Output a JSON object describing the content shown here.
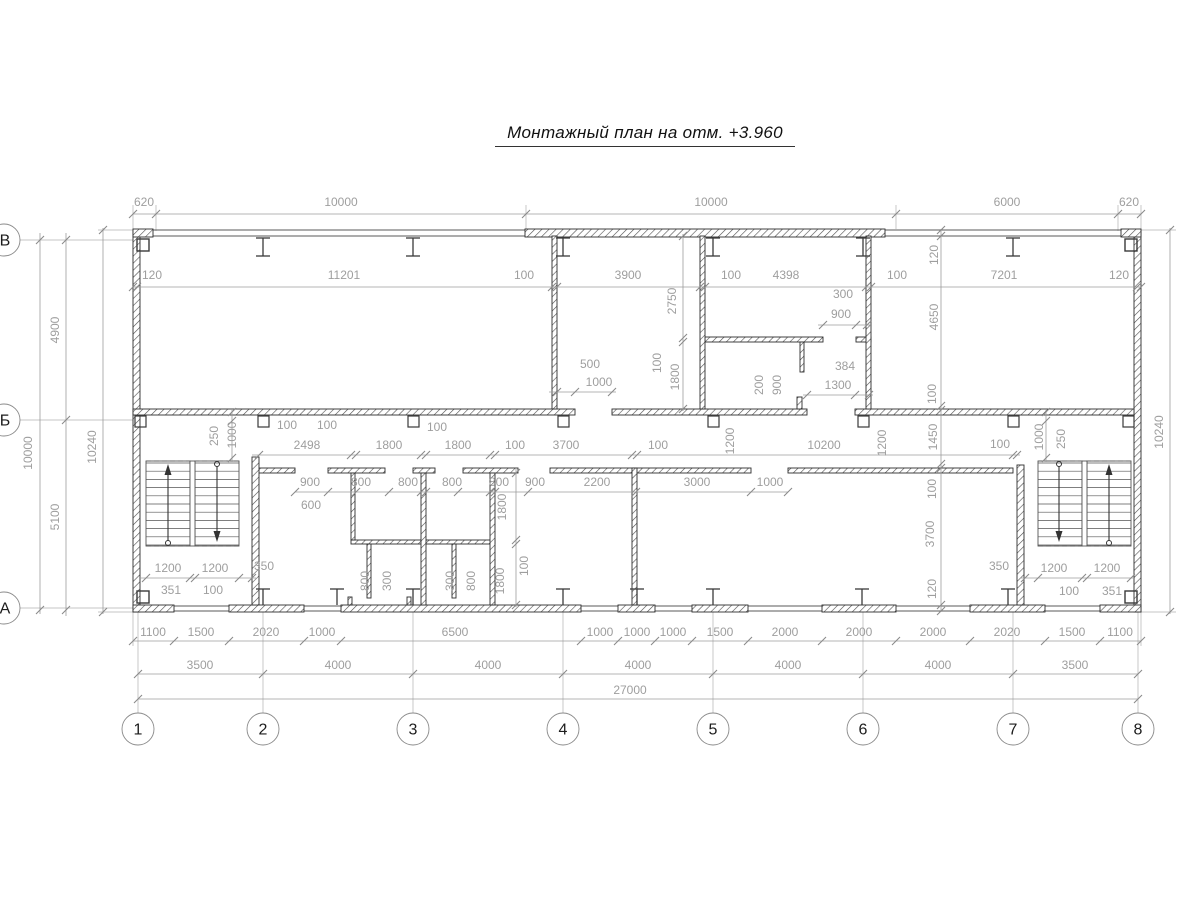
{
  "plan": {
    "title": "Монтажный план на отм. +3.960",
    "colors": {
      "wall_stroke": "#2d2d2d",
      "hatch": "#4f4f4f",
      "dim_line": "#9c9c9c",
      "dim_text": "#9e9e9e",
      "axis_text": "#1c1c1c",
      "thin_wall": "#5a5a5a",
      "ext_line": "#b0b0b0",
      "symbol": "#3a3a3a",
      "stair": "#555555"
    },
    "axes_bottom": [
      {
        "label": "1",
        "x": 138
      },
      {
        "label": "2",
        "x": 263
      },
      {
        "label": "3",
        "x": 413
      },
      {
        "label": "4",
        "x": 563
      },
      {
        "label": "5",
        "x": 713
      },
      {
        "label": "6",
        "x": 863
      },
      {
        "label": "7",
        "x": 1013
      },
      {
        "label": "8",
        "x": 1138
      }
    ],
    "axes_bottom_y": 729,
    "axes_r": 16,
    "axes_left": [
      {
        "label": "В",
        "y": 240
      },
      {
        "label": "Б",
        "y": 420
      },
      {
        "label": "А",
        "y": 608
      }
    ],
    "window_lines": [
      [
        133,
        230,
        1141,
        230
      ],
      [
        133,
        236,
        1141,
        236
      ],
      [
        133,
        606,
        1141,
        606
      ],
      [
        133,
        611,
        1141,
        611
      ]
    ],
    "walls": [
      [
        133,
        230,
        7,
        382
      ],
      [
        1134,
        230,
        7,
        382
      ],
      [
        133,
        229,
        20,
        8
      ],
      [
        1121,
        229,
        20,
        8
      ],
      [
        525,
        229,
        360,
        8
      ],
      [
        133,
        605,
        41,
        7
      ],
      [
        229,
        605,
        75,
        7
      ],
      [
        341,
        605,
        240,
        7
      ],
      [
        618,
        605,
        37,
        7
      ],
      [
        692,
        605,
        56,
        7
      ],
      [
        822,
        605,
        74,
        7
      ],
      [
        970,
        605,
        75,
        7
      ],
      [
        1100,
        605,
        41,
        7
      ],
      [
        133,
        409,
        442,
        6
      ],
      [
        612,
        409,
        195,
        6
      ],
      [
        855,
        409,
        279,
        6
      ],
      [
        258,
        468,
        37,
        5
      ],
      [
        328,
        468,
        57,
        5
      ],
      [
        413,
        468,
        22,
        5
      ],
      [
        463,
        468,
        55,
        5
      ],
      [
        550,
        468,
        201,
        5
      ],
      [
        788,
        468,
        225,
        5
      ],
      [
        705,
        337,
        118,
        5
      ],
      [
        856,
        337,
        15,
        5
      ],
      [
        351,
        540,
        144,
        4
      ],
      [
        552,
        236,
        5,
        173
      ],
      [
        700,
        236,
        5,
        173
      ],
      [
        866,
        236,
        5,
        173
      ],
      [
        252,
        457,
        7,
        148
      ],
      [
        1017,
        465,
        7,
        140
      ],
      [
        632,
        468,
        5,
        137
      ],
      [
        421,
        473,
        5,
        132
      ],
      [
        490,
        473,
        5,
        132
      ],
      [
        351,
        473,
        4,
        67
      ],
      [
        367,
        544,
        4,
        54
      ],
      [
        452,
        544,
        4,
        54
      ],
      [
        348,
        597,
        4,
        8
      ],
      [
        407,
        597,
        4,
        8
      ],
      [
        800,
        342,
        4,
        30
      ],
      [
        797,
        397,
        5,
        12
      ]
    ],
    "columns_top": [
      263,
      413,
      563,
      713,
      863,
      1013
    ],
    "columns_bottom": [
      263,
      337,
      413,
      563,
      637,
      713,
      862,
      1008
    ],
    "wall_stubs": [
      140,
      263,
      413,
      563,
      713,
      863,
      1013,
      1128
    ],
    "corner_squares": [
      [
        137,
        239
      ],
      [
        1125,
        239
      ],
      [
        137,
        591
      ],
      [
        1125,
        591
      ]
    ],
    "stairs": [
      {
        "flights": [
          [
            146,
            44
          ],
          [
            195,
            44
          ]
        ],
        "divider": [
          190,
          461,
          5,
          85
        ],
        "span": [
          146,
          239
        ],
        "dashed": [
          461,
          546
        ],
        "arrows": [
          {
            "x": 168,
            "dir": "up"
          },
          {
            "x": 217,
            "dir": "down"
          }
        ]
      },
      {
        "flights": [
          [
            1038,
            44
          ],
          [
            1087,
            44
          ]
        ],
        "divider": [
          1082,
          461,
          5,
          85
        ],
        "span": [
          1038,
          1131
        ],
        "dashed": [
          461,
          546
        ],
        "arrows": [
          {
            "x": 1059,
            "dir": "down"
          },
          {
            "x": 1109,
            "dir": "up"
          }
        ]
      }
    ],
    "stair_tread_top": 463,
    "stair_tread_bot": 545,
    "stair_treads": 10,
    "dim_lines": [
      {
        "o": "h",
        "c": 214,
        "a": 133,
        "b": 1141,
        "ticks": [
          133,
          156,
          526,
          896,
          1118,
          1141
        ]
      },
      {
        "o": "h",
        "c": 287,
        "a": 133,
        "b": 1141,
        "ticks": [
          133,
          137,
          552,
          557,
          700,
          705,
          866,
          871,
          1137,
          1141
        ]
      },
      {
        "o": "h",
        "c": 641,
        "a": 133,
        "b": 1141,
        "ticks": [
          133,
          174,
          229,
          304,
          341,
          581,
          618,
          655,
          692,
          748,
          822,
          896,
          970,
          1045,
          1100,
          1141
        ]
      },
      {
        "o": "h",
        "c": 674,
        "a": 138,
        "b": 1138,
        "ticks": [
          138,
          263,
          413,
          563,
          713,
          863,
          1013,
          1138
        ]
      },
      {
        "o": "h",
        "c": 699,
        "a": 138,
        "b": 1138,
        "ticks": [
          138,
          1138
        ]
      },
      {
        "o": "h",
        "c": 455,
        "a": 252,
        "b": 1020,
        "ticks": [
          259,
          351,
          356,
          421,
          426,
          490,
          495,
          632,
          637,
          1013,
          1017
        ]
      },
      {
        "o": "h",
        "c": 492,
        "a": 295,
        "b": 788,
        "ticks": [
          295,
          328,
          356,
          389,
          421,
          426,
          458,
          490,
          495,
          528,
          636,
          751,
          788
        ]
      },
      {
        "o": "h",
        "c": 392,
        "a": 549,
        "b": 616,
        "ticks": [
          557,
          575,
          612
        ]
      },
      {
        "o": "h",
        "c": 395,
        "a": 803,
        "b": 873,
        "ticks": [
          807,
          855,
          869
        ]
      },
      {
        "o": "h",
        "c": 325,
        "a": 818,
        "b": 871,
        "ticks": [
          823,
          856,
          867
        ]
      },
      {
        "o": "h",
        "c": 578,
        "a": 140,
        "b": 256,
        "ticks": [
          146,
          190,
          195,
          239,
          252
        ]
      },
      {
        "o": "h",
        "c": 578,
        "a": 1020,
        "b": 1134,
        "ticks": [
          1025,
          1038,
          1082,
          1087,
          1131
        ]
      },
      {
        "o": "v",
        "c": 40,
        "a": 233,
        "b": 614,
        "ticks": [
          240,
          610
        ]
      },
      {
        "o": "v",
        "c": 66,
        "a": 233,
        "b": 616,
        "ticks": [
          240,
          420,
          610
        ]
      },
      {
        "o": "v",
        "c": 103,
        "a": 228,
        "b": 614,
        "ticks": [
          230,
          612
        ]
      },
      {
        "o": "v",
        "c": 1170,
        "a": 228,
        "b": 614,
        "ticks": [
          230,
          612
        ]
      },
      {
        "o": "v",
        "c": 941,
        "a": 229,
        "b": 612,
        "ticks": [
          230,
          236,
          406,
          410,
          464,
          468,
          605,
          611
        ]
      },
      {
        "o": "v",
        "c": 683,
        "a": 234,
        "b": 411,
        "ticks": [
          236,
          338,
          342,
          409
        ]
      },
      {
        "o": "v",
        "c": 232,
        "a": 409,
        "b": 462,
        "ticks": [
          412,
          421,
          458
        ]
      },
      {
        "o": "v",
        "c": 1046,
        "a": 409,
        "b": 462,
        "ticks": [
          412,
          421,
          458
        ]
      },
      {
        "o": "v",
        "c": 516,
        "a": 468,
        "b": 607,
        "ticks": [
          473,
          540,
          544,
          605
        ]
      }
    ],
    "ext_lines": [
      [
        156,
        205,
        156,
        231
      ],
      [
        526,
        205,
        526,
        229
      ],
      [
        896,
        205,
        896,
        229
      ],
      [
        1118,
        205,
        1118,
        231
      ],
      [
        133,
        205,
        133,
        229
      ],
      [
        1141,
        205,
        1141,
        229
      ],
      [
        552,
        240,
        552,
        292
      ],
      [
        557,
        240,
        557,
        292
      ],
      [
        700,
        240,
        700,
        292
      ],
      [
        705,
        240,
        705,
        292
      ],
      [
        866,
        240,
        866,
        292
      ],
      [
        871,
        240,
        871,
        292
      ],
      [
        133,
        240,
        133,
        292
      ],
      [
        137,
        240,
        137,
        292
      ],
      [
        1137,
        240,
        1137,
        292
      ],
      [
        1141,
        240,
        1141,
        292
      ],
      [
        138,
        612,
        138,
        713
      ],
      [
        263,
        612,
        263,
        713
      ],
      [
        413,
        612,
        413,
        713
      ],
      [
        563,
        612,
        563,
        713
      ],
      [
        713,
        612,
        713,
        713
      ],
      [
        863,
        612,
        863,
        713
      ],
      [
        1013,
        612,
        1013,
        713
      ],
      [
        1138,
        612,
        1138,
        713
      ],
      [
        133,
        612,
        133,
        646
      ],
      [
        1141,
        612,
        1141,
        646
      ],
      [
        20,
        240,
        133,
        240
      ],
      [
        20,
        420,
        133,
        420
      ],
      [
        20,
        608,
        133,
        608
      ],
      [
        98,
        230,
        133,
        230
      ],
      [
        98,
        612,
        133,
        612
      ],
      [
        1141,
        230,
        1176,
        230
      ],
      [
        1141,
        612,
        1176,
        612
      ]
    ],
    "labels_h": [
      {
        "t": "620",
        "x": 144,
        "y": 206
      },
      {
        "t": "10000",
        "x": 341,
        "y": 206
      },
      {
        "t": "10000",
        "x": 711,
        "y": 206
      },
      {
        "t": "6000",
        "x": 1007,
        "y": 206
      },
      {
        "t": "620",
        "x": 1129,
        "y": 206
      },
      {
        "t": "120",
        "x": 152,
        "y": 279
      },
      {
        "t": "11201",
        "x": 344,
        "y": 279
      },
      {
        "t": "100",
        "x": 524,
        "y": 279
      },
      {
        "t": "3900",
        "x": 628,
        "y": 279
      },
      {
        "t": "100",
        "x": 731,
        "y": 279
      },
      {
        "t": "4398",
        "x": 786,
        "y": 279
      },
      {
        "t": "100",
        "x": 897,
        "y": 279
      },
      {
        "t": "7201",
        "x": 1004,
        "y": 279
      },
      {
        "t": "120",
        "x": 1119,
        "y": 279
      },
      {
        "t": "2498",
        "x": 307,
        "y": 449
      },
      {
        "t": "1800",
        "x": 389,
        "y": 449
      },
      {
        "t": "1800",
        "x": 458,
        "y": 449
      },
      {
        "t": "3700",
        "x": 566,
        "y": 449
      },
      {
        "t": "10200",
        "x": 824,
        "y": 449
      },
      {
        "t": "100",
        "x": 287,
        "y": 429
      },
      {
        "t": "100",
        "x": 327,
        "y": 429
      },
      {
        "t": "100",
        "x": 437,
        "y": 431
      },
      {
        "t": "100",
        "x": 515,
        "y": 449
      },
      {
        "t": "100",
        "x": 658,
        "y": 449
      },
      {
        "t": "100",
        "x": 1000,
        "y": 448
      },
      {
        "t": "900",
        "x": 310,
        "y": 486
      },
      {
        "t": "800",
        "x": 361,
        "y": 486
      },
      {
        "t": "800",
        "x": 408,
        "y": 486
      },
      {
        "t": "800",
        "x": 452,
        "y": 486
      },
      {
        "t": "800",
        "x": 499,
        "y": 486
      },
      {
        "t": "900",
        "x": 535,
        "y": 486
      },
      {
        "t": "2200",
        "x": 597,
        "y": 486
      },
      {
        "t": "3000",
        "x": 697,
        "y": 486
      },
      {
        "t": "1000",
        "x": 770,
        "y": 486
      },
      {
        "t": "600",
        "x": 311,
        "y": 509
      },
      {
        "t": "500",
        "x": 590,
        "y": 368
      },
      {
        "t": "1000",
        "x": 599,
        "y": 386
      },
      {
        "t": "300",
        "x": 843,
        "y": 298
      },
      {
        "t": "900",
        "x": 841,
        "y": 318
      },
      {
        "t": "384",
        "x": 845,
        "y": 370
      },
      {
        "t": "1300",
        "x": 838,
        "y": 389
      },
      {
        "t": "1200",
        "x": 168,
        "y": 572
      },
      {
        "t": "1200",
        "x": 215,
        "y": 572
      },
      {
        "t": "350",
        "x": 264,
        "y": 570
      },
      {
        "t": "351",
        "x": 171,
        "y": 594
      },
      {
        "t": "100",
        "x": 213,
        "y": 594
      },
      {
        "t": "350",
        "x": 999,
        "y": 570
      },
      {
        "t": "1200",
        "x": 1054,
        "y": 572
      },
      {
        "t": "1200",
        "x": 1107,
        "y": 572
      },
      {
        "t": "100",
        "x": 1069,
        "y": 595
      },
      {
        "t": "351",
        "x": 1112,
        "y": 595
      },
      {
        "t": "1100",
        "x": 153,
        "y": 636
      },
      {
        "t": "1500",
        "x": 201,
        "y": 636
      },
      {
        "t": "2020",
        "x": 266,
        "y": 636
      },
      {
        "t": "1000",
        "x": 322,
        "y": 636
      },
      {
        "t": "6500",
        "x": 455,
        "y": 636
      },
      {
        "t": "1000",
        "x": 600,
        "y": 636
      },
      {
        "t": "1000",
        "x": 637,
        "y": 636
      },
      {
        "t": "1000",
        "x": 673,
        "y": 636
      },
      {
        "t": "1500",
        "x": 720,
        "y": 636
      },
      {
        "t": "2000",
        "x": 785,
        "y": 636
      },
      {
        "t": "2000",
        "x": 859,
        "y": 636
      },
      {
        "t": "2000",
        "x": 933,
        "y": 636
      },
      {
        "t": "2020",
        "x": 1007,
        "y": 636
      },
      {
        "t": "1500",
        "x": 1072,
        "y": 636
      },
      {
        "t": "1100",
        "x": 1120,
        "y": 636
      },
      {
        "t": "3500",
        "x": 200,
        "y": 669
      },
      {
        "t": "4000",
        "x": 338,
        "y": 669
      },
      {
        "t": "4000",
        "x": 488,
        "y": 669
      },
      {
        "t": "4000",
        "x": 638,
        "y": 669
      },
      {
        "t": "4000",
        "x": 788,
        "y": 669
      },
      {
        "t": "4000",
        "x": 938,
        "y": 669
      },
      {
        "t": "3500",
        "x": 1075,
        "y": 669
      },
      {
        "t": "27000",
        "x": 630,
        "y": 694
      }
    ],
    "labels_v": [
      {
        "t": "4900",
        "x": 59,
        "y": 330
      },
      {
        "t": "10000",
        "x": 32,
        "y": 453
      },
      {
        "t": "10240",
        "x": 96,
        "y": 447
      },
      {
        "t": "5100",
        "x": 59,
        "y": 517
      },
      {
        "t": "10240",
        "x": 1163,
        "y": 432
      },
      {
        "t": "2750",
        "x": 676,
        "y": 301
      },
      {
        "t": "100",
        "x": 661,
        "y": 363
      },
      {
        "t": "1800",
        "x": 679,
        "y": 377
      },
      {
        "t": "200",
        "x": 763,
        "y": 385
      },
      {
        "t": "900",
        "x": 781,
        "y": 385
      },
      {
        "t": "250",
        "x": 218,
        "y": 436
      },
      {
        "t": "1000",
        "x": 236,
        "y": 435
      },
      {
        "t": "1200",
        "x": 734,
        "y": 441
      },
      {
        "t": "1200",
        "x": 886,
        "y": 443
      },
      {
        "t": "1000",
        "x": 1043,
        "y": 437
      },
      {
        "t": "250",
        "x": 1065,
        "y": 439
      },
      {
        "t": "120",
        "x": 938,
        "y": 255
      },
      {
        "t": "4650",
        "x": 938,
        "y": 317
      },
      {
        "t": "100",
        "x": 936,
        "y": 394
      },
      {
        "t": "1450",
        "x": 937,
        "y": 437
      },
      {
        "t": "100",
        "x": 936,
        "y": 489
      },
      {
        "t": "3700",
        "x": 934,
        "y": 534
      },
      {
        "t": "120",
        "x": 936,
        "y": 589
      },
      {
        "t": "1800",
        "x": 506,
        "y": 507
      },
      {
        "t": "100",
        "x": 528,
        "y": 566
      },
      {
        "t": "1800",
        "x": 504,
        "y": 581
      },
      {
        "t": "800",
        "x": 369,
        "y": 581
      },
      {
        "t": "300",
        "x": 391,
        "y": 581
      },
      {
        "t": "300",
        "x": 454,
        "y": 581
      },
      {
        "t": "800",
        "x": 475,
        "y": 581
      }
    ]
  }
}
